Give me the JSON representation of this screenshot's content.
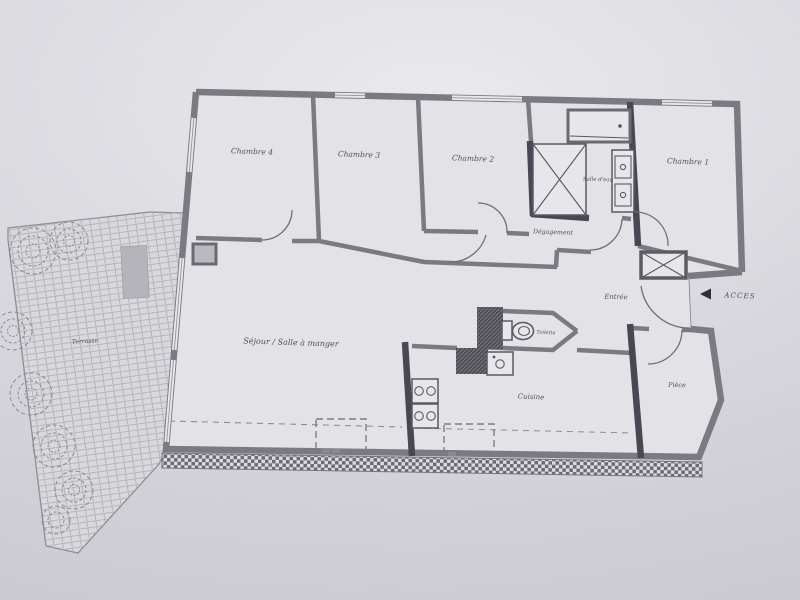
{
  "plan": {
    "rooms": {
      "chambre4": "Chambre 4",
      "chambre3": "Chambre 3",
      "chambre2": "Chambre 2",
      "chambre1": "Chambre 1",
      "salle_deau": "Salle d'eau",
      "degagement": "Dégagement",
      "entree": "Entrée",
      "sejour": "Séjour / Salle à manger",
      "toilette": "Toilette",
      "cuisine": "Cuisine",
      "piece": "Pièce",
      "terrasse": "Terrasse"
    },
    "access_label": "ACCES",
    "colors": {
      "paper": "#dcdbe0",
      "interior": "#e3e2e7",
      "wall": "#7b7a82",
      "wall_dark": "#494852",
      "ink": "#3b3a49"
    }
  }
}
